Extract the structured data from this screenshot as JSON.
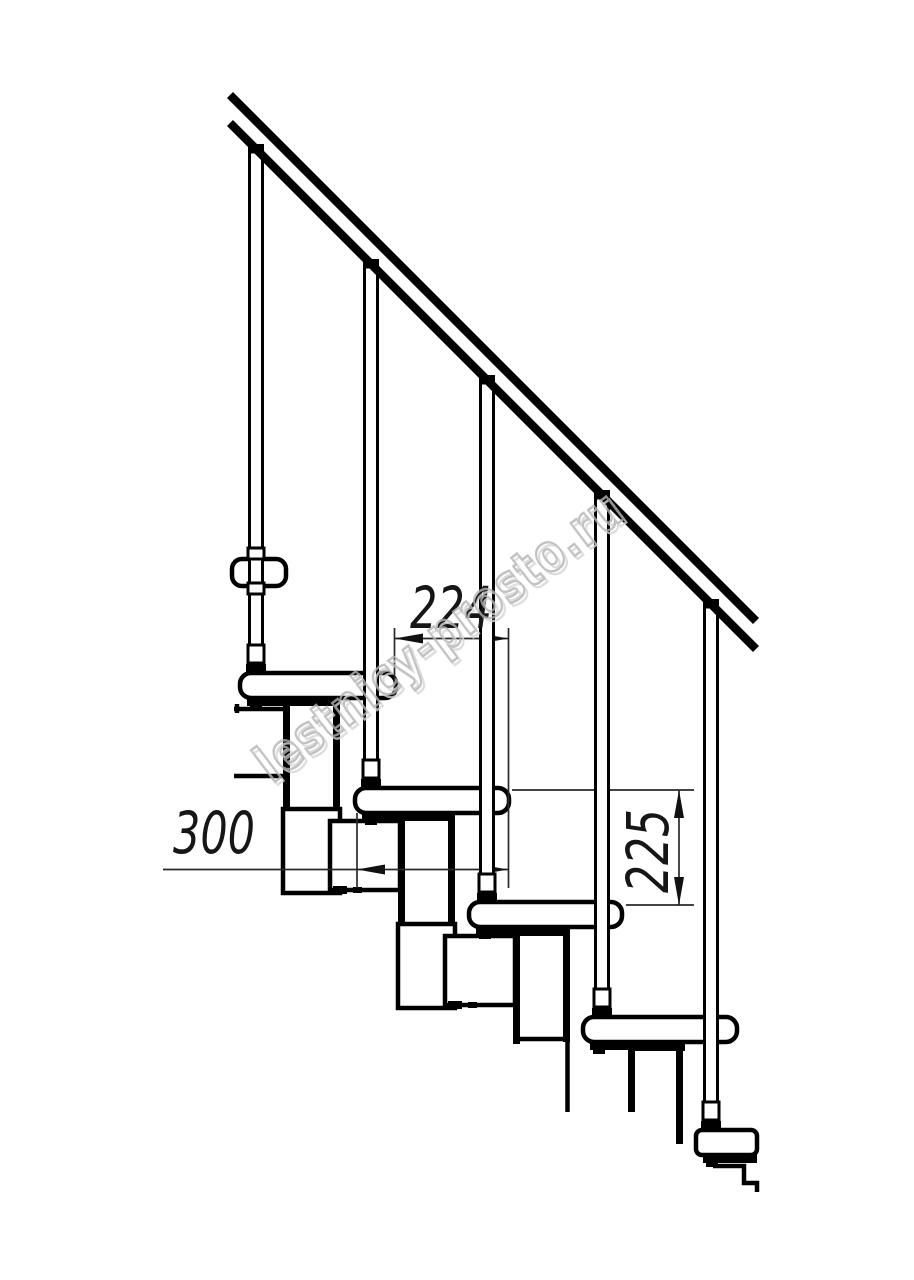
{
  "drawing": {
    "kind": "staircase-side-view-technical-drawing",
    "line_color": "#000000",
    "background_color": "#ffffff",
    "dimension_line_color": "#2a2a2a",
    "balusters_count": 5,
    "treads_count": 6,
    "handrail": true
  },
  "dimensions": {
    "step_run": {
      "label": "224"
    },
    "module_depth": {
      "label": "300"
    },
    "step_rise": {
      "label": "225"
    }
  },
  "watermark": {
    "text": "lestnicy-prosto.ru",
    "color": "#b3b3b3"
  }
}
